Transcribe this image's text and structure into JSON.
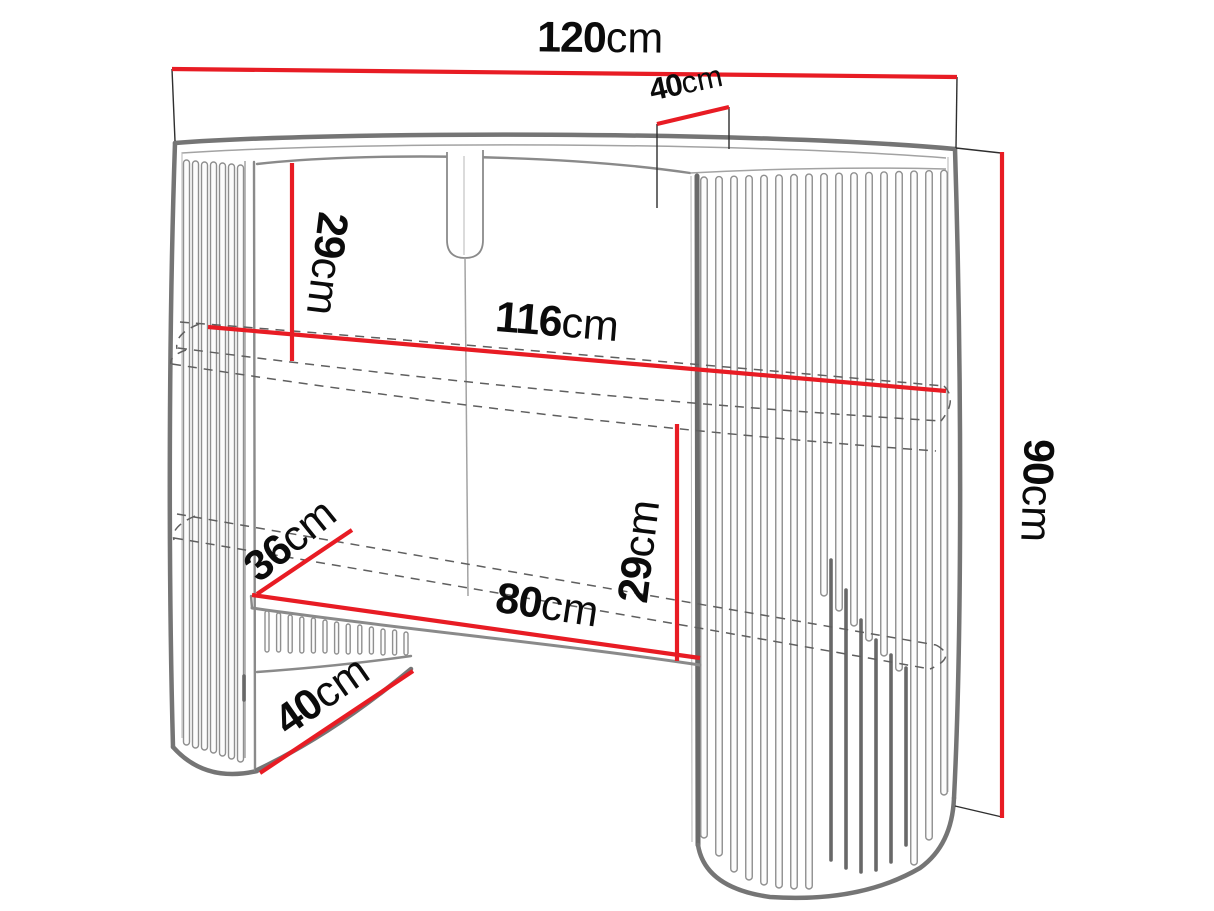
{
  "diagram": {
    "unit_suffix": "cm",
    "colors": {
      "dimension_red": "#e81c24",
      "outline_gray": "#757575",
      "hidden_edge_gray": "#5f5f5f",
      "text_black": "#0b0b0b",
      "background": "#ffffff"
    },
    "dimensions": [
      {
        "id": "total-width",
        "value": "120",
        "unit": "cm"
      },
      {
        "id": "top-depth",
        "value": "40",
        "unit": "cm"
      },
      {
        "id": "top-to-shelf",
        "value": "29",
        "unit": "cm"
      },
      {
        "id": "inner-width",
        "value": "116",
        "unit": "cm"
      },
      {
        "id": "shelf-to-base",
        "value": "29",
        "unit": "cm"
      },
      {
        "id": "shelf-depth",
        "value": "36",
        "unit": "cm"
      },
      {
        "id": "opening-width",
        "value": "80",
        "unit": "cm"
      },
      {
        "id": "base-depth",
        "value": "40",
        "unit": "cm"
      },
      {
        "id": "total-height",
        "value": "90",
        "unit": "cm"
      }
    ]
  }
}
